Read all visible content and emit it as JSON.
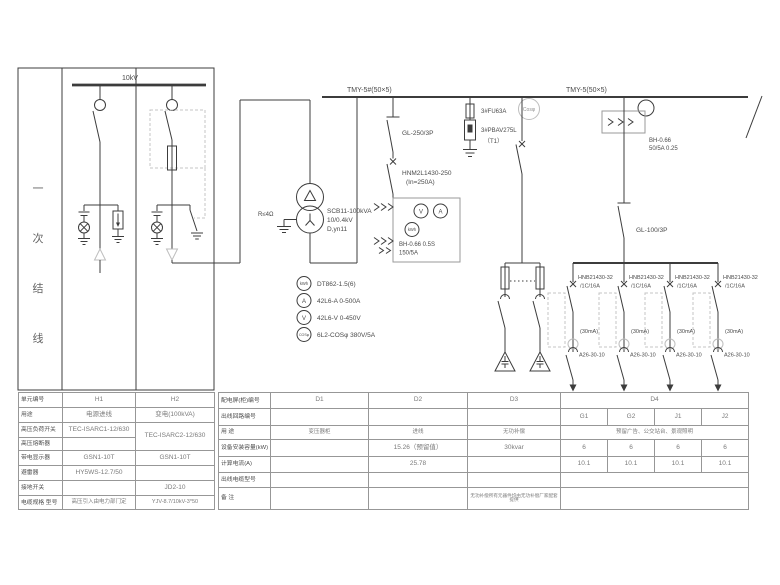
{
  "diagram": {
    "title_chars": [
      "一",
      "次",
      "结",
      "线"
    ],
    "hv_bus": "10kV",
    "bus_left": "TMY-5#(50×5)",
    "bus_right": "TMY-5(50×5)",
    "xfmr_model": "SCB11-100kVA",
    "xfmr_ratio": "10/0.4kV",
    "xfmr_vector": "D,yn11",
    "xfmr_ground": "R≤4Ω",
    "incomer_switch": "GL-250/3P",
    "incomer_breaker": "HNM2L1430-250",
    "incomer_breaker_in": "(In=250A)",
    "incomer_ct_line1": "BH-0.66 0.5S",
    "incomer_ct_line2": "150/5A",
    "meter_v": "V",
    "meter_a": "A",
    "meter_kwh": "kWh",
    "meter_cos": "Cosφ",
    "spd_fuse": "3#FU63A",
    "spd_model": "3#PBAV275L",
    "spd_tag": "（T1）",
    "main_ct_line1": "BH-0.66",
    "main_ct_line2": "50/5A 0.25",
    "main_switch": "GL-100/3P",
    "feeder_model": "HNB21430-32",
    "feeder_spec": "/1C/16A",
    "feeder_rcd": "(30mA)",
    "feeder_contactor": "A26-30-10",
    "legend": [
      {
        "icon": "kWh",
        "label": "DT862-1.5(6)"
      },
      {
        "icon": "A",
        "label": "42L6-A 0-500A"
      },
      {
        "icon": "V",
        "label": "42L6-V 0-450V"
      },
      {
        "icon": "COSφ",
        "label": "6L2-COSφ 380V/5A"
      }
    ]
  },
  "left_table": {
    "rows": [
      {
        "label": "单元编号",
        "h1": "H1",
        "h2": "H2"
      },
      {
        "label": "用途",
        "h1": "电源进线",
        "h2": "变电(100kVA)"
      },
      {
        "label": "高压负荷开关",
        "h1": "TEC-ISARC1-12/630",
        "h2": "TEC-ISARC2-12/630"
      },
      {
        "label": "高压熔断器",
        "h1": ""
      },
      {
        "label": "带电显示器",
        "h1": "GSN1-10T",
        "h2": "GSN1-10T"
      },
      {
        "label": "避雷器",
        "h1": "HY5WS-12.7/50",
        "h2": ""
      },
      {
        "label": "接地开关",
        "h1": "",
        "h2": "JD2-10"
      },
      {
        "label": "电缆规格 型号",
        "h1": "高压引入由电力部门定",
        "h2": "YJV-8.7/10kV-3*50"
      }
    ]
  },
  "right_table": {
    "row_labels": [
      "配电屏(柜)编号",
      "出线回路编号",
      "用 途",
      "设备安装容量(kW)",
      "计算电流(A)",
      "出线电缆型号",
      "备 注"
    ],
    "panels": {
      "d1": "D1",
      "d2": "D2",
      "d3": "D3",
      "d4": "D4"
    },
    "circuits": [
      "G1",
      "G2",
      "J1",
      "J2"
    ],
    "usage": {
      "d1": "变压器柜",
      "d2": "进线",
      "d3": "无功补偿",
      "d4": "预留广告、公交站台、景观照明"
    },
    "capacity": {
      "d1": "",
      "d2": "15.26（预留值）",
      "d3": "30kvar",
      "g": [
        "6",
        "6",
        "6",
        "6"
      ]
    },
    "current": {
      "d1": "",
      "d2": "25.78",
      "d3": "",
      "g": [
        "10.1",
        "10.1",
        "10.1",
        "10.1"
      ]
    },
    "cable": {
      "d1": "",
      "d2": "",
      "d3": "",
      "d4": ""
    },
    "remark": {
      "d1": "",
      "d2": "",
      "d3": "无功补偿所有元器件均由无功补偿厂家配套提供",
      "d4": ""
    }
  }
}
